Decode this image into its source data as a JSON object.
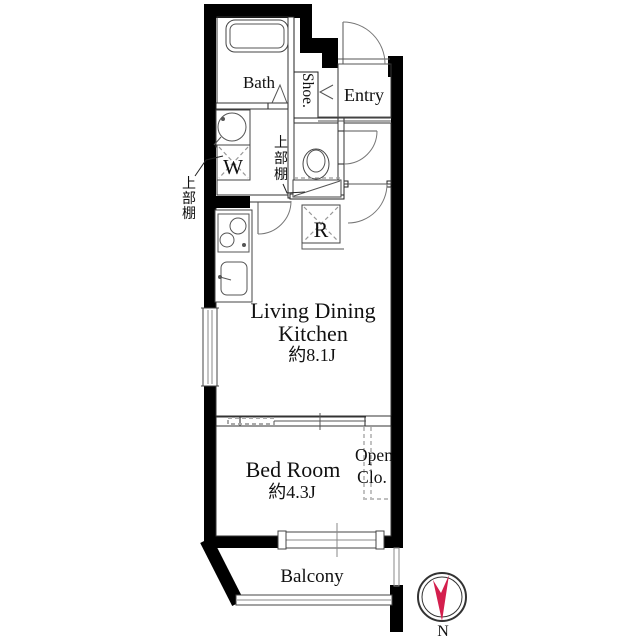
{
  "floor_plan": {
    "rooms": {
      "bath": {
        "label": "Bath"
      },
      "shoe_cabinet": {
        "label": "Shoe."
      },
      "entry": {
        "label": "Entry"
      },
      "living_dining_kitchen": {
        "line1": "Living Dining",
        "line2": "Kitchen",
        "area": "約8.1J"
      },
      "bed_room": {
        "label": "Bed Room",
        "area": "約4.3J"
      },
      "open_closet": {
        "line1": "Open",
        "line2": "Clo."
      },
      "balcony": {
        "label": "Balcony"
      }
    },
    "fixtures": {
      "washing_machine": {
        "label": "W"
      },
      "refrigerator": {
        "label": "R"
      },
      "upper_shelf_left": {
        "label": "上部棚",
        "chars": [
          "上",
          "部",
          "棚"
        ]
      },
      "upper_shelf_wc": {
        "label": "上部棚",
        "chars": [
          "上",
          "部",
          "棚"
        ]
      }
    },
    "compass": {
      "north_label": "N",
      "needle_color": "#d41f4d"
    },
    "colors": {
      "wall": "#000000",
      "line": "#333333",
      "fixture_line": "#555555"
    }
  }
}
